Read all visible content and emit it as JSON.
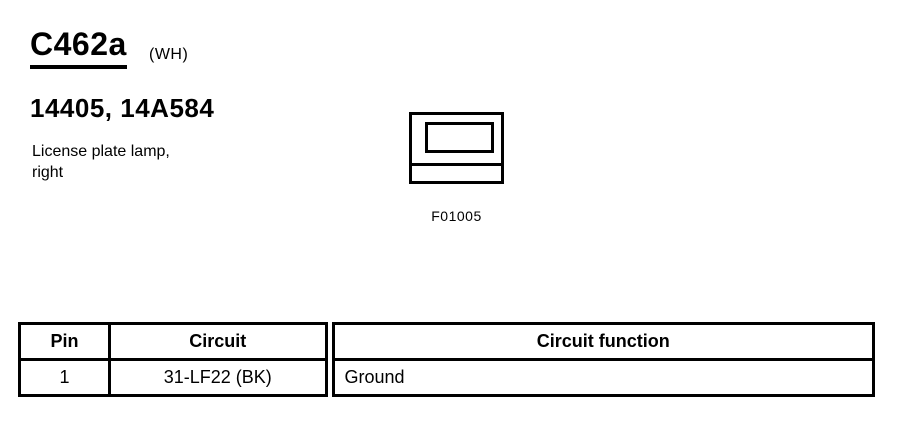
{
  "colors": {
    "ink": "#000000",
    "paper": "#ffffff"
  },
  "header": {
    "connector_id": "C462a",
    "color_code": "(WH)",
    "part_numbers": "14405, 14A584",
    "description": [
      "License plate lamp,",
      "right"
    ]
  },
  "figure": {
    "label": "F01005"
  },
  "pin_table": {
    "headers": [
      "Pin",
      "Circuit",
      "Circuit function"
    ],
    "rows": [
      {
        "pin": "1",
        "circuit": "31-LF22 (BK)",
        "function": "Ground"
      }
    ]
  }
}
